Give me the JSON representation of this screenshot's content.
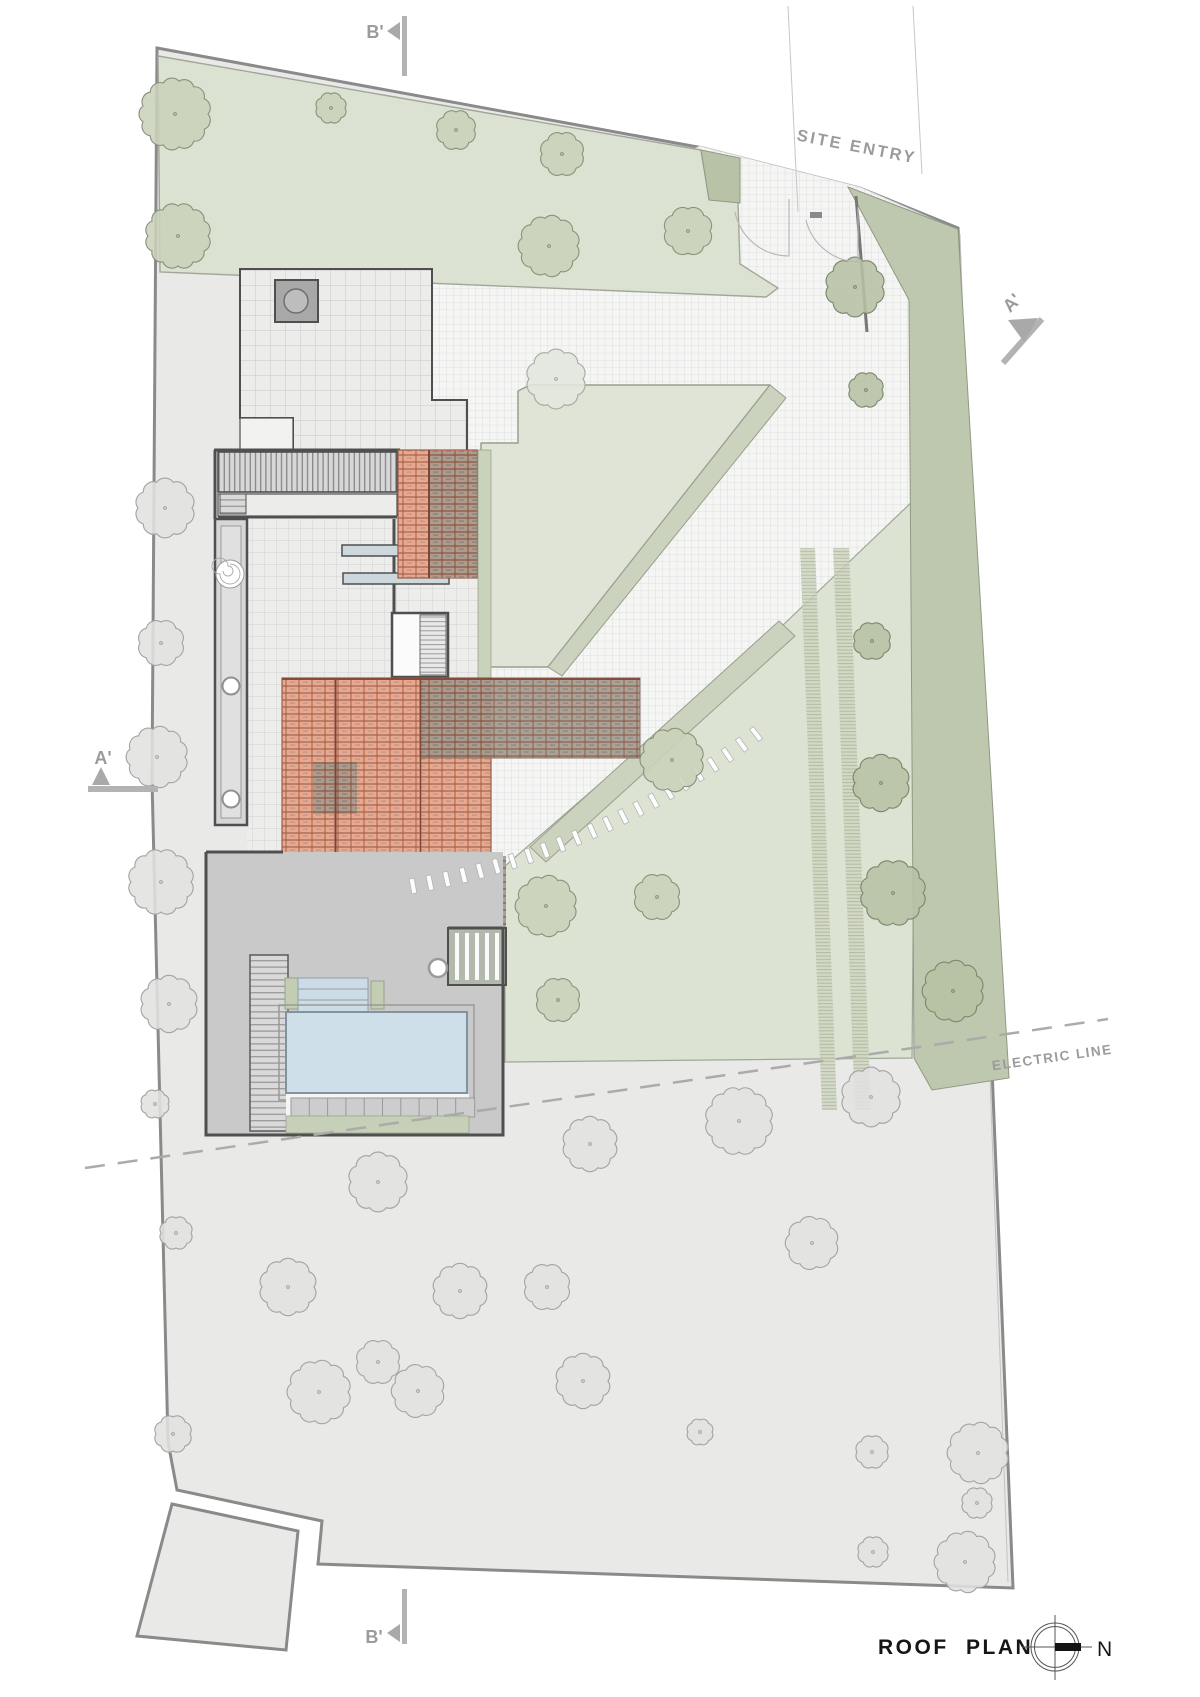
{
  "drawing": {
    "title": "ROOF PLAN",
    "north_label": "N"
  },
  "labels": {
    "site_entry": "SITE ENTRY",
    "electric_line": "ELECTRIC LINE",
    "section_a_left": "A'",
    "section_a_right": "A'",
    "section_b_top": "B'",
    "section_b_bottom": "B'"
  },
  "colors": {
    "site_fill": "#e9e9e8",
    "boundary": "#8a8a8a",
    "lawn": "#dce2d2",
    "dark_green_band": "#bdc8ae",
    "island_green": "#dfe4d6",
    "ramp": "#cbd2be",
    "roof_tile": "#e9a78e",
    "roof_tile_edge": "#b0715a",
    "roof_tile_dark": "#a29a8d",
    "pool_water": "#cfdfea",
    "deck": "#c9c9c9",
    "wall": "#4f4f4f",
    "annotation": "#9b9b9b",
    "tree": {
      "green": {
        "fill": "#c9d2b9",
        "stroke": "#88917a"
      },
      "band": {
        "fill": "#b7c2a5",
        "stroke": "#7c866c"
      },
      "gray": {
        "fill": "#e1e1e0",
        "stroke": "#a3a3a3"
      },
      "grid": {
        "fill": "#e4e7de",
        "stroke": "#a6aa9e"
      }
    }
  },
  "trees": [
    [
      175,
      114,
      33,
      "green"
    ],
    [
      331,
      108,
      14,
      "green"
    ],
    [
      456,
      130,
      18,
      "green"
    ],
    [
      562,
      154,
      20,
      "green"
    ],
    [
      178,
      236,
      30,
      "green"
    ],
    [
      549,
      246,
      28,
      "green"
    ],
    [
      688,
      231,
      22,
      "green"
    ],
    [
      855,
      287,
      27,
      "band"
    ],
    [
      866,
      390,
      16,
      "band"
    ],
    [
      872,
      641,
      17,
      "band"
    ],
    [
      881,
      783,
      26,
      "band"
    ],
    [
      893,
      893,
      30,
      "band"
    ],
    [
      953,
      991,
      28,
      "band"
    ],
    [
      556,
      379,
      27,
      "grid"
    ],
    [
      672,
      760,
      29,
      "green"
    ],
    [
      546,
      906,
      28,
      "green"
    ],
    [
      657,
      897,
      21,
      "green"
    ],
    [
      558,
      1000,
      20,
      "green"
    ],
    [
      165,
      508,
      27,
      "gray"
    ],
    [
      161,
      643,
      21,
      "gray"
    ],
    [
      157,
      757,
      28,
      "gray"
    ],
    [
      161,
      882,
      30,
      "gray"
    ],
    [
      169,
      1004,
      26,
      "gray"
    ],
    [
      155,
      1104,
      13,
      "gray"
    ],
    [
      378,
      1182,
      27,
      "gray"
    ],
    [
      590,
      1144,
      25,
      "gray"
    ],
    [
      739,
      1121,
      31,
      "gray"
    ],
    [
      871,
      1097,
      27,
      "gray"
    ],
    [
      176,
      1233,
      15,
      "gray"
    ],
    [
      288,
      1287,
      26,
      "gray"
    ],
    [
      460,
      1291,
      25,
      "gray"
    ],
    [
      547,
      1287,
      21,
      "gray"
    ],
    [
      812,
      1243,
      24,
      "gray"
    ],
    [
      378,
      1362,
      20,
      "gray"
    ],
    [
      583,
      1381,
      25,
      "gray"
    ],
    [
      173,
      1434,
      17,
      "gray"
    ],
    [
      319,
      1392,
      29,
      "gray"
    ],
    [
      418,
      1391,
      24,
      "gray"
    ],
    [
      700,
      1432,
      12,
      "gray"
    ],
    [
      872,
      1452,
      15,
      "gray"
    ],
    [
      978,
      1453,
      28,
      "gray"
    ],
    [
      977,
      1503,
      14,
      "gray"
    ],
    [
      965,
      1562,
      28,
      "gray"
    ],
    [
      873,
      1552,
      14,
      "gray"
    ]
  ],
  "stepping_path": {
    "count": 23,
    "from": [
      413,
      886
    ],
    "ctrl": [
      600,
      852
    ],
    "to": [
      756,
      734
    ]
  },
  "pool": {
    "stone_count": 10,
    "stones_start_x": 291,
    "stones_step": 18.3,
    "stones_y": 1098,
    "stone_size": 19,
    "lane_line_ys": [
      989,
      1000
    ]
  }
}
